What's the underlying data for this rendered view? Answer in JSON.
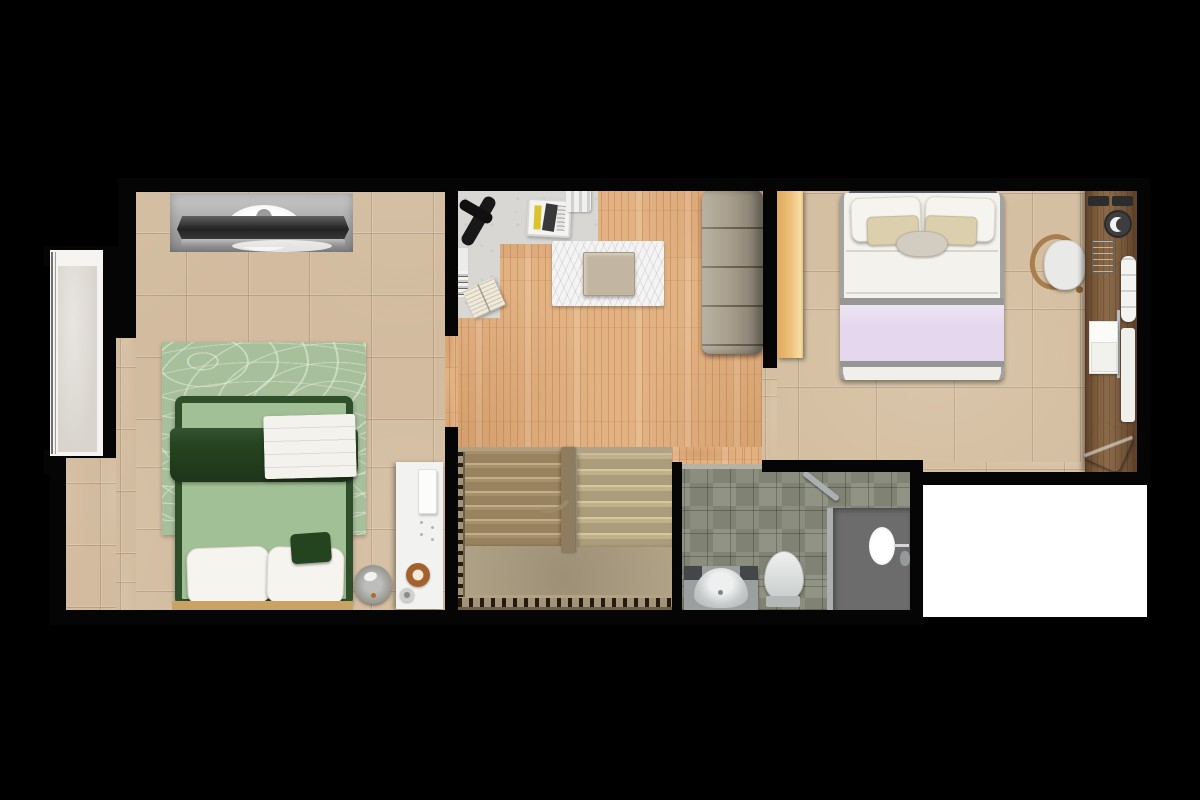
{
  "meta": {
    "title": "Apartment floor plan (top-down render)",
    "view": "top-down",
    "canvas": {
      "width_px": 1200,
      "height_px": 800
    }
  },
  "palette": {
    "background": "#000000",
    "wall": "#050505",
    "tile_beige": "#d2bb9e",
    "tile_beige_right": "#d5bfa2",
    "tile_grout": "#b49c7e",
    "wood_floor": "#e2b283",
    "wood_plank_dark": "#c08a55",
    "concrete": "#d8d7d4",
    "window_fill": "#d9d5ce",
    "niche_gray": "#b5b5b5",
    "tv_dark": "#303030",
    "rug_green": "#a8bf9c",
    "rug_green_line": "#e3edd8",
    "bed_frame_green": "#2f4f2b",
    "mattress_green": "#a2c095",
    "blanket_green": "#254420",
    "pillow_white": "#f6f4ef",
    "foot_wood": "#c9a266",
    "shelf_white": "#f2f2f0",
    "donut_brown": "#a5602f",
    "fluffy_rug": "#f4f4f4",
    "table_beige": "#c2b6a2",
    "sofa_taupe": "#a89e8c",
    "sofa_seam": "#7e7465",
    "stair_tan": "#b0a287",
    "stair_tread": "#a18a66",
    "stair_tread_light": "#c7b895",
    "baluster_dark": "#2e2519",
    "bath_tile": "#8b8e7e",
    "shower_gray": "#6c6c6c",
    "glass_gray": "#aab0b2",
    "fixture_white": "#e3e6e5",
    "vanity_gray": "#b9bdbd",
    "vanity_dark": "#43474a",
    "wardrobe_tan": "#ecc27c",
    "headboard_gray": "#5d6466",
    "lavender": "#e5d7ed",
    "band_gray": "#969696",
    "pillow_beige": "#dbcfae",
    "desk_wood": "#7e5c3e",
    "chair_wood": "#a87e4d",
    "towel_blue": "#7fa9d9",
    "terrace_white": "#ffffff"
  },
  "rooms": {
    "bedroom_left": {
      "label": "Bedroom (left) — beige tile floor",
      "furniture": {
        "tv": "TV console in gray wall niche",
        "window": "Window opening with sill",
        "rug": "Green contour-pattern area rug",
        "bed": "Double bed, green bedding, white pillows",
        "throw": "White folded throw",
        "shelf": "White side shelf with accessories",
        "fan": "Round table fan",
        "donut": "Brown round tray"
      }
    },
    "living": {
      "label": "Living / hall — oak plank floor",
      "furniture": {
        "nook": "Concrete reading nook with books",
        "tool": "Black exercise bar",
        "magazine_box": "Magazine box with yellow spine",
        "towels": "Rolled towels",
        "fluffy_rug": "White shag rug",
        "table": "Low coffee table",
        "sofa": "Tufted bench sofa"
      }
    },
    "stairs": {
      "label": "U-shaped staircase with baluster railing"
    },
    "bathroom": {
      "label": "Bathroom — green stone tile",
      "furniture": {
        "vanity": "Vanity sink",
        "toilet": "Toilet",
        "shower": "Walk-in shower with glass door"
      }
    },
    "bedroom_right": {
      "label": "Bedroom (right) — beige tile floor",
      "furniture": {
        "wardrobe": "Tan wardrobe",
        "bed": "Double bed, white duvet, lavender throw",
        "chair": "Wood-frame desk chair",
        "desk": "Built-in wooden desk",
        "desk_items": "Remotes, clock, radio, towel roll, papers, pen",
        "towel": "Blue folded towel"
      }
    },
    "terrace": {
      "label": "Open light well / terrace (white)"
    }
  }
}
